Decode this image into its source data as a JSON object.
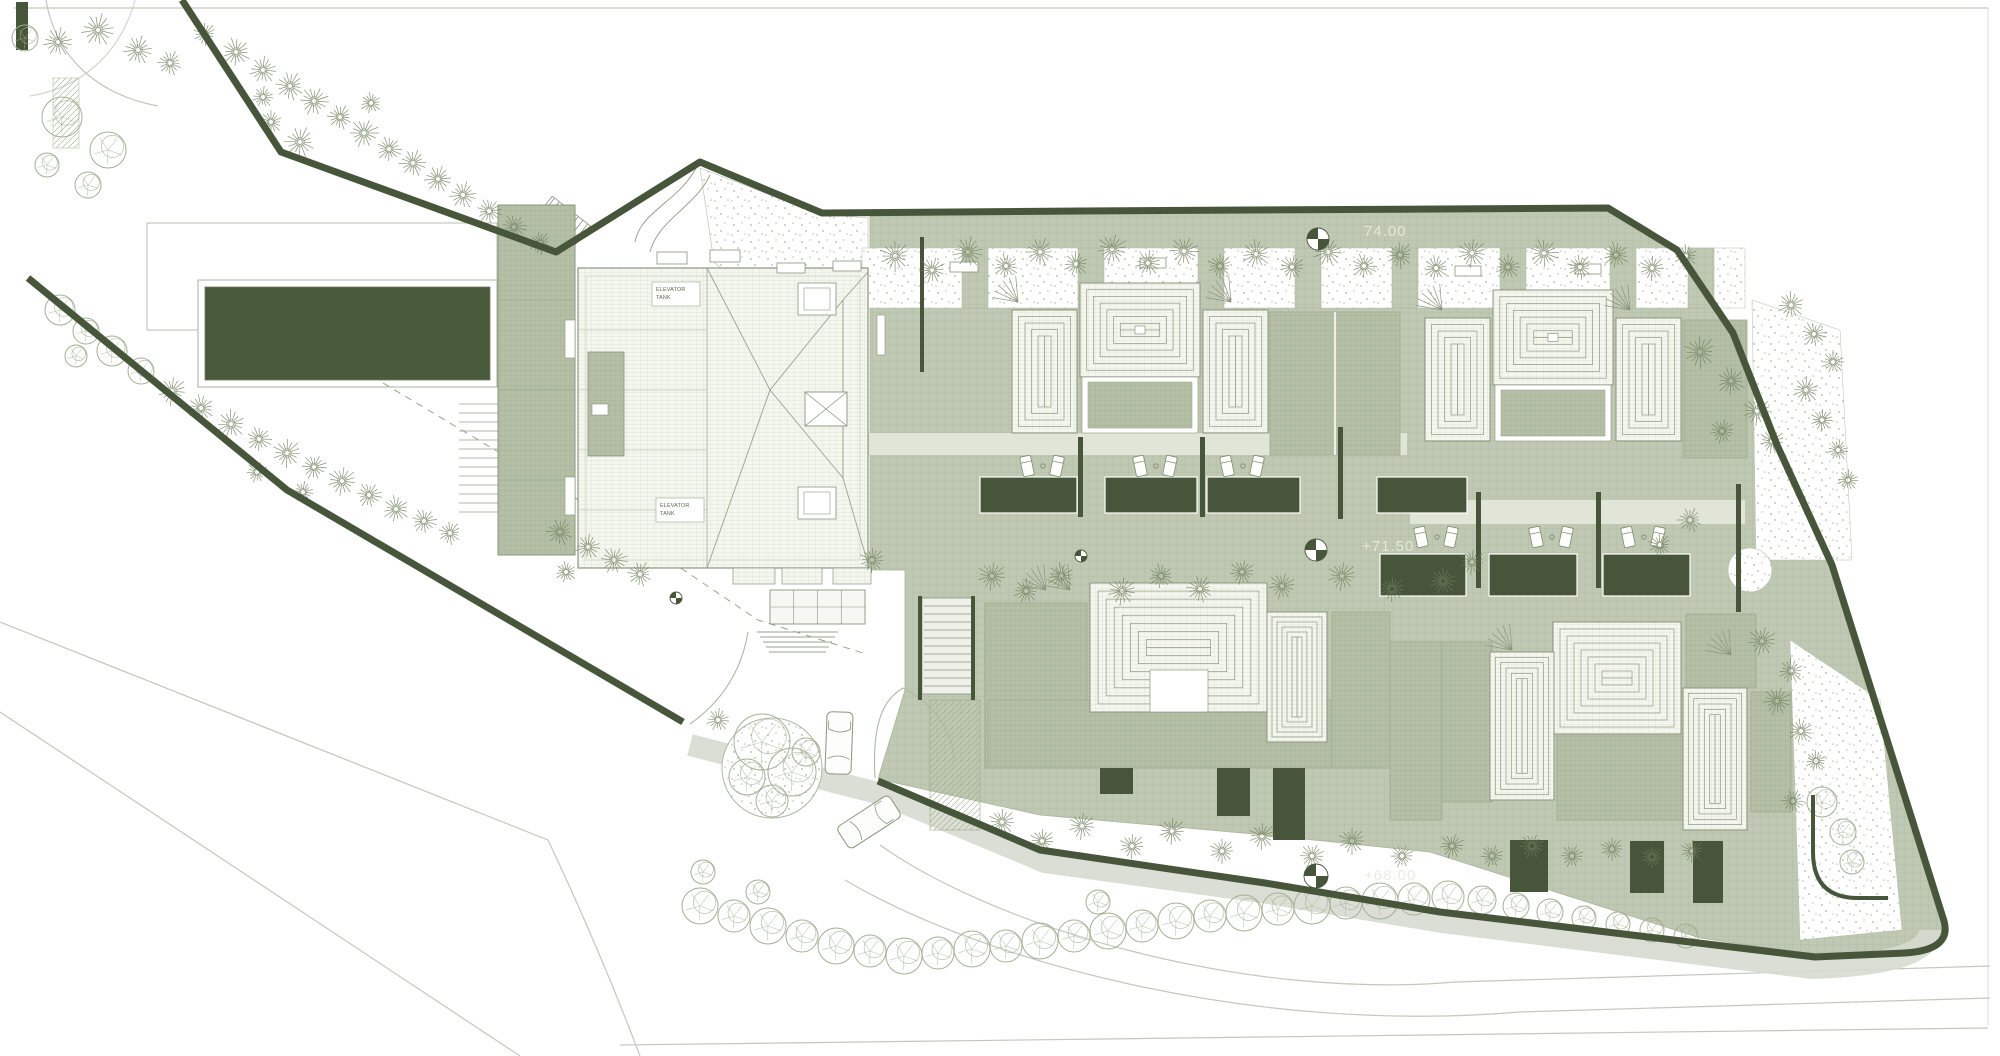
{
  "drawing": {
    "kind": "architectural roof / site plan",
    "levels": [
      {
        "text": "74.00",
        "x": 1364,
        "y": 236
      },
      {
        "text": "+71.50",
        "x": 1362,
        "y": 551
      },
      {
        "text": "+68.00",
        "x": 1364,
        "y": 880
      }
    ],
    "equipment_labels": [
      {
        "lines": [
          "ELEVATOR",
          "TANK"
        ],
        "x": 652,
        "y": 282,
        "w": 48,
        "h": 24
      },
      {
        "lines": [
          "ELEVATOR",
          "TANK"
        ],
        "x": 656,
        "y": 498,
        "w": 48,
        "h": 24
      }
    ]
  },
  "colors": {
    "paper": "#ffffff",
    "paving": "#bfc8b2",
    "pavingLine": "#acb89d",
    "slab": "#b4bfa5",
    "slabLine": "#9fac90",
    "tileBg": "#f4f6ef",
    "tileLine": "#d2d9c5",
    "dark": "#47563b",
    "outline": "#8b957e",
    "ring": "#8d9a7e",
    "pine": "#6f7e5c",
    "round": "#a4b094",
    "boundary": "#47563b",
    "road": "#c3c7bd",
    "stipple": "#8e9b7f",
    "walk": "#e0e5d8",
    "street": "#d6dacf",
    "levelText": "#e8ecdf",
    "dash": "#9aa38d",
    "labelText": "#5c684d"
  },
  "benchmarks": [
    {
      "x": 1318,
      "y": 239,
      "r": 11
    },
    {
      "x": 1316,
      "y": 550,
      "r": 11
    },
    {
      "x": 1316,
      "y": 876,
      "r": 12
    },
    {
      "x": 1081,
      "y": 556,
      "r": 6
    },
    {
      "x": 676,
      "y": 598,
      "r": 6
    }
  ],
  "v_units": [
    [
      1012,
      310,
      65,
      123
    ],
    [
      1203,
      310,
      65,
      123
    ],
    [
      1425,
      318,
      65,
      123
    ],
    [
      1616,
      318,
      65,
      123
    ]
  ],
  "pyr_units": [
    [
      1080,
      283,
      120,
      94
    ],
    [
      1493,
      290,
      120,
      95
    ]
  ],
  "aprons": [
    [
      1270,
      312,
      130,
      143
    ],
    [
      1683,
      320,
      64,
      138
    ],
    [
      985,
      603,
      102,
      165
    ],
    [
      988,
      700,
      404,
      68
    ],
    [
      1332,
      612,
      58,
      156
    ],
    [
      1390,
      642,
      52,
      178
    ],
    [
      1442,
      642,
      50,
      160
    ],
    [
      1557,
      736,
      126,
      84
    ],
    [
      1686,
      614,
      70,
      74
    ],
    [
      1751,
      692,
      40,
      120
    ]
  ],
  "villa_concentric": [
    {
      "x": 1090,
      "y": 583,
      "w": 177,
      "h": 129,
      "steps": 7
    },
    {
      "x": 1267,
      "y": 612,
      "w": 60,
      "h": 130,
      "steps": 5
    },
    {
      "x": 1553,
      "y": 622,
      "w": 128,
      "h": 112,
      "steps": 7
    },
    {
      "x": 1490,
      "y": 652,
      "w": 64,
      "h": 148,
      "steps": 5
    },
    {
      "x": 1683,
      "y": 688,
      "w": 64,
      "h": 142,
      "steps": 5
    }
  ],
  "villa_notch": {
    "x": 1150,
    "y": 670,
    "w": 58,
    "h": 42
  },
  "piers": [
    962,
    1078,
    1198,
    1295,
    1392,
    1500,
    1610,
    1688
  ],
  "planters": [
    [
      980,
      477,
      97,
      36
    ],
    [
      1105,
      477,
      92,
      36
    ],
    [
      1207,
      477,
      93,
      36
    ],
    [
      1377,
      477,
      90,
      36
    ],
    [
      1380,
      554,
      86,
      42
    ],
    [
      1489,
      554,
      88,
      42
    ],
    [
      1603,
      554,
      87,
      42
    ]
  ],
  "lightwells": [
    [
      1100,
      768,
      33,
      26
    ],
    [
      1217,
      768,
      33,
      48
    ],
    [
      1273,
      768,
      32,
      72
    ],
    [
      1510,
      840,
      38,
      52
    ],
    [
      1630,
      841,
      34,
      52
    ],
    [
      1693,
      841,
      30,
      62
    ]
  ],
  "walls": [
    [
      1078,
      437,
      5,
      80
    ],
    [
      1200,
      437,
      5,
      80
    ],
    [
      1338,
      427,
      5,
      92
    ],
    [
      1476,
      492,
      5,
      96
    ],
    [
      1596,
      492,
      5,
      96
    ],
    [
      1736,
      484,
      5,
      128
    ],
    [
      918,
      596,
      4,
      104
    ],
    [
      971,
      596,
      4,
      104
    ],
    [
      920,
      237,
      4,
      135
    ]
  ],
  "loungers": [
    [
      1043,
      466
    ],
    [
      1156,
      466
    ],
    [
      1243,
      466
    ],
    [
      1437,
      537
    ],
    [
      1552,
      537
    ],
    [
      1644,
      537
    ]
  ],
  "benches": [
    [
      657,
      252,
      30,
      12
    ],
    [
      710,
      250,
      30,
      12
    ],
    [
      777,
      263,
      28,
      10
    ],
    [
      833,
      261,
      28,
      10
    ],
    [
      950,
      262,
      28,
      10
    ],
    [
      1140,
      258,
      26,
      10
    ],
    [
      1455,
      266,
      26,
      10
    ],
    [
      1575,
      264,
      26,
      10
    ]
  ],
  "fans": [
    [
      1018,
      302
    ],
    [
      1231,
      302
    ],
    [
      1442,
      310
    ],
    [
      1630,
      310
    ],
    [
      1046,
      590
    ],
    [
      1070,
      590
    ],
    [
      1512,
      650
    ],
    [
      1731,
      655
    ]
  ],
  "chips": [
    [
      565,
      320,
      10,
      38
    ],
    [
      565,
      477,
      10,
      38
    ],
    [
      877,
      315,
      8,
      40
    ],
    [
      592,
      404,
      16,
      11
    ]
  ],
  "roof_squares": [
    [
      798,
      283,
      38,
      32
    ],
    [
      798,
      487,
      38,
      32
    ]
  ],
  "x_square": [
    805,
    392,
    42,
    34
  ],
  "canopies": [
    [
      733,
      568,
      42,
      16
    ],
    [
      782,
      568,
      40,
      16
    ],
    [
      833,
      568,
      38,
      16
    ]
  ],
  "glass_canopy": [
    770,
    590,
    95,
    34
  ],
  "circle_court": {
    "x": 1750,
    "y": 570,
    "r": 22
  },
  "cars": [
    {
      "x": 839,
      "y": 743,
      "rot": 2
    },
    {
      "x": 869,
      "y": 822,
      "rot": 57
    }
  ],
  "trees": {
    "pine": [
      [
        58,
        42,
        15
      ],
      [
        98,
        30,
        17
      ],
      [
        138,
        50,
        15
      ],
      [
        170,
        63,
        13
      ],
      [
        205,
        34,
        12
      ],
      [
        236,
        52,
        15
      ],
      [
        263,
        70,
        14
      ],
      [
        290,
        86,
        15
      ],
      [
        263,
        97,
        11
      ],
      [
        314,
        101,
        15
      ],
      [
        340,
        117,
        13
      ],
      [
        364,
        133,
        15
      ],
      [
        389,
        149,
        13
      ],
      [
        300,
        142,
        16
      ],
      [
        271,
        122,
        12
      ],
      [
        413,
        163,
        14
      ],
      [
        438,
        179,
        14
      ],
      [
        463,
        195,
        14
      ],
      [
        489,
        211,
        13
      ],
      [
        514,
        227,
        13
      ],
      [
        540,
        243,
        12
      ],
      [
        371,
        103,
        11
      ],
      [
        172,
        391,
        15
      ],
      [
        201,
        408,
        14
      ],
      [
        231,
        424,
        15
      ],
      [
        259,
        439,
        13
      ],
      [
        287,
        453,
        15
      ],
      [
        314,
        467,
        13
      ],
      [
        342,
        481,
        15
      ],
      [
        369,
        495,
        13
      ],
      [
        396,
        509,
        14
      ],
      [
        257,
        472,
        11
      ],
      [
        303,
        492,
        11
      ],
      [
        424,
        521,
        13
      ],
      [
        450,
        533,
        12
      ],
      [
        560,
        532,
        14
      ],
      [
        588,
        547,
        13
      ],
      [
        614,
        560,
        14
      ],
      [
        640,
        574,
        13
      ],
      [
        566,
        572,
        11
      ],
      [
        718,
        720,
        12
      ],
      [
        895,
        256,
        16
      ],
      [
        932,
        270,
        14
      ],
      [
        968,
        252,
        16
      ],
      [
        1006,
        266,
        13
      ],
      [
        1040,
        252,
        15
      ],
      [
        1076,
        264,
        13
      ],
      [
        1112,
        249,
        16
      ],
      [
        1148,
        263,
        13
      ],
      [
        1184,
        251,
        15
      ],
      [
        1220,
        266,
        13
      ],
      [
        1256,
        254,
        15
      ],
      [
        1292,
        267,
        13
      ],
      [
        1328,
        252,
        15
      ],
      [
        1364,
        266,
        13
      ],
      [
        1400,
        255,
        14
      ],
      [
        1436,
        268,
        13
      ],
      [
        1472,
        253,
        15
      ],
      [
        1508,
        267,
        13
      ],
      [
        1544,
        253,
        15
      ],
      [
        1580,
        267,
        13
      ],
      [
        1616,
        255,
        14
      ],
      [
        1652,
        268,
        13
      ],
      [
        1686,
        256,
        12
      ],
      [
        1700,
        352,
        17
      ],
      [
        1731,
        381,
        15
      ],
      [
        1757,
        411,
        15
      ],
      [
        1722,
        431,
        13
      ],
      [
        1772,
        441,
        13
      ],
      [
        1791,
        305,
        14
      ],
      [
        1814,
        334,
        13
      ],
      [
        1833,
        362,
        12
      ],
      [
        1806,
        390,
        14
      ],
      [
        1822,
        420,
        12
      ],
      [
        1838,
        450,
        11
      ],
      [
        1848,
        480,
        11
      ],
      [
        992,
        576,
        15
      ],
      [
        1026,
        591,
        13
      ],
      [
        1061,
        576,
        14
      ],
      [
        1122,
        591,
        15
      ],
      [
        1161,
        576,
        13
      ],
      [
        1200,
        589,
        14
      ],
      [
        1242,
        572,
        13
      ],
      [
        1282,
        586,
        14
      ],
      [
        1342,
        576,
        15
      ],
      [
        1392,
        589,
        13
      ],
      [
        1443,
        581,
        14
      ],
      [
        1472,
        562,
        13
      ],
      [
        872,
        560,
        13
      ],
      [
        1690,
        520,
        13
      ],
      [
        1660,
        545,
        12
      ],
      [
        1002,
        822,
        14
      ],
      [
        1042,
        841,
        13
      ],
      [
        1082,
        826,
        14
      ],
      [
        1132,
        846,
        13
      ],
      [
        1172,
        831,
        14
      ],
      [
        1222,
        851,
        13
      ],
      [
        1262,
        836,
        14
      ],
      [
        1312,
        856,
        13
      ],
      [
        1352,
        841,
        14
      ],
      [
        1402,
        856,
        12
      ],
      [
        1452,
        846,
        13
      ],
      [
        1492,
        856,
        12
      ],
      [
        1532,
        846,
        13
      ],
      [
        1572,
        856,
        12
      ],
      [
        1612,
        849,
        12
      ],
      [
        1652,
        857,
        11
      ],
      [
        1692,
        851,
        12
      ],
      [
        1762,
        641,
        15
      ],
      [
        1791,
        671,
        13
      ],
      [
        1777,
        701,
        15
      ],
      [
        1801,
        731,
        13
      ],
      [
        1816,
        761,
        11
      ],
      [
        1793,
        801,
        12
      ]
    ],
    "round": [
      [
        25,
        38,
        13
      ],
      [
        62,
        117,
        20
      ],
      [
        108,
        150,
        18
      ],
      [
        47,
        165,
        12
      ],
      [
        88,
        185,
        13
      ],
      [
        60,
        310,
        15
      ],
      [
        86,
        331,
        13
      ],
      [
        112,
        351,
        15
      ],
      [
        141,
        371,
        13
      ],
      [
        76,
        356,
        11
      ],
      [
        762,
        742,
        28
      ],
      [
        792,
        772,
        24
      ],
      [
        747,
        777,
        18
      ],
      [
        772,
        801,
        16
      ],
      [
        806,
        752,
        14
      ],
      [
        700,
        906,
        18
      ],
      [
        734,
        916,
        16
      ],
      [
        768,
        926,
        18
      ],
      [
        802,
        936,
        16
      ],
      [
        836,
        946,
        18
      ],
      [
        870,
        951,
        16
      ],
      [
        904,
        956,
        18
      ],
      [
        938,
        953,
        16
      ],
      [
        972,
        949,
        18
      ],
      [
        1006,
        946,
        16
      ],
      [
        1040,
        941,
        18
      ],
      [
        1074,
        936,
        16
      ],
      [
        1108,
        931,
        18
      ],
      [
        1142,
        926,
        16
      ],
      [
        1176,
        921,
        18
      ],
      [
        1210,
        916,
        16
      ],
      [
        1244,
        913,
        18
      ],
      [
        1278,
        909,
        16
      ],
      [
        1312,
        906,
        18
      ],
      [
        1346,
        903,
        16
      ],
      [
        1380,
        901,
        18
      ],
      [
        1414,
        899,
        16
      ],
      [
        1448,
        897,
        16
      ],
      [
        703,
        872,
        12
      ],
      [
        758,
        892,
        12
      ],
      [
        1098,
        902,
        12
      ],
      [
        1482,
        900,
        14
      ],
      [
        1516,
        906,
        13
      ],
      [
        1550,
        912,
        13
      ],
      [
        1584,
        918,
        12
      ],
      [
        1618,
        924,
        12
      ],
      [
        1652,
        930,
        12
      ],
      [
        1686,
        936,
        12
      ],
      [
        1822,
        802,
        15
      ],
      [
        1843,
        832,
        13
      ],
      [
        1852,
        862,
        12
      ]
    ]
  }
}
